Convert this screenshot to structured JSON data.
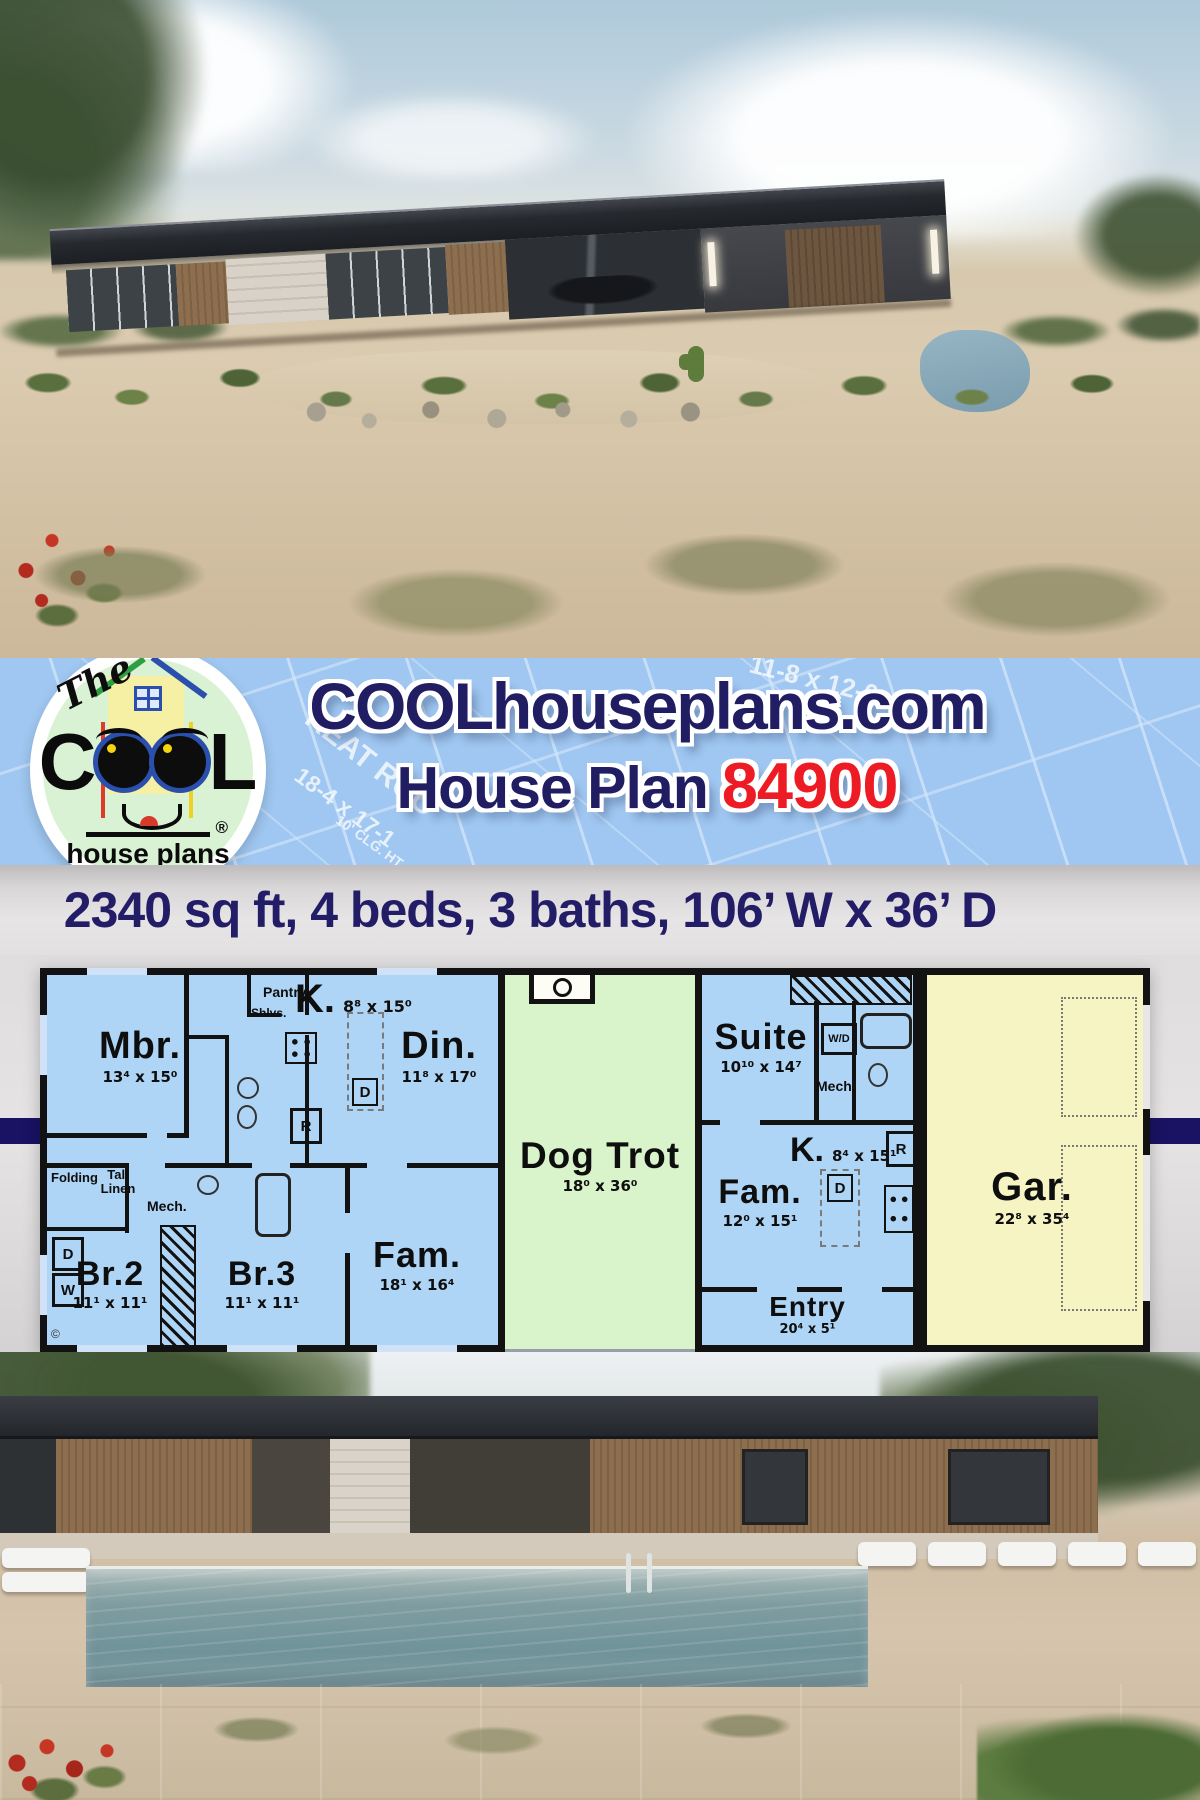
{
  "banner": {
    "site_title": "COOLhouseplans.com",
    "plan_label": "House Plan",
    "plan_number": "84900",
    "logo": {
      "the": "The",
      "c": "C",
      "l": "L",
      "house_plans": "house plans",
      "company": "company",
      "registered": "®"
    },
    "watermarks": [
      "11-8 x 12-0",
      "REAT ROO",
      "18-4 x 17-1",
      "10' CLG. HT."
    ]
  },
  "stats": {
    "line": "2340 sq ft, 4 beds, 3 baths, 106’ W x 36’ D"
  },
  "floor_plan": {
    "rooms": {
      "mbr": {
        "label": "Mbr.",
        "dims": "13⁴ x 15⁰"
      },
      "k_left": {
        "label": "K.",
        "dims": "8⁸ x 15⁰"
      },
      "din": {
        "label": "Din.",
        "dims": "11⁸ x 17⁰"
      },
      "fam_left": {
        "label": "Fam.",
        "dims": "18¹ x 16⁴"
      },
      "br2": {
        "label": "Br.2",
        "dims": "11¹ x 11¹"
      },
      "br3": {
        "label": "Br.3",
        "dims": "11¹ x 11¹"
      },
      "dog_trot": {
        "label": "Dog Trot",
        "dims": "18⁰ x 36⁰"
      },
      "suite": {
        "label": "Suite",
        "dims": "10¹⁰ x 14⁷"
      },
      "k_right": {
        "label": "K.",
        "dims": "8⁴ x 15¹"
      },
      "fam_right": {
        "label": "Fam.",
        "dims": "12⁰ x 15¹"
      },
      "entry": {
        "label": "Entry",
        "dims": "20⁴ x 5¹"
      },
      "gar": {
        "label": "Gar.",
        "dims": "22⁸ x 35⁴"
      }
    },
    "labels": {
      "pantry": "Pantry",
      "shlvs": "Shlvs.",
      "folding": "Folding",
      "tall_linen": "Tall Linen",
      "mech": "Mech.",
      "wd": "W/D",
      "washer": "W",
      "dryer": "D",
      "fridge": "R",
      "dishwasher": "D",
      "copyright": "©"
    }
  },
  "colors": {
    "banner_blue": "#9fc7f1",
    "navy": "#211d63",
    "red": "#ed1c24",
    "room_blue": "#aed4f6",
    "dogtrot_green": "#d9f3cb",
    "garage_yellow": "#f7f4c4",
    "stripe_navy": "#1a1263"
  }
}
